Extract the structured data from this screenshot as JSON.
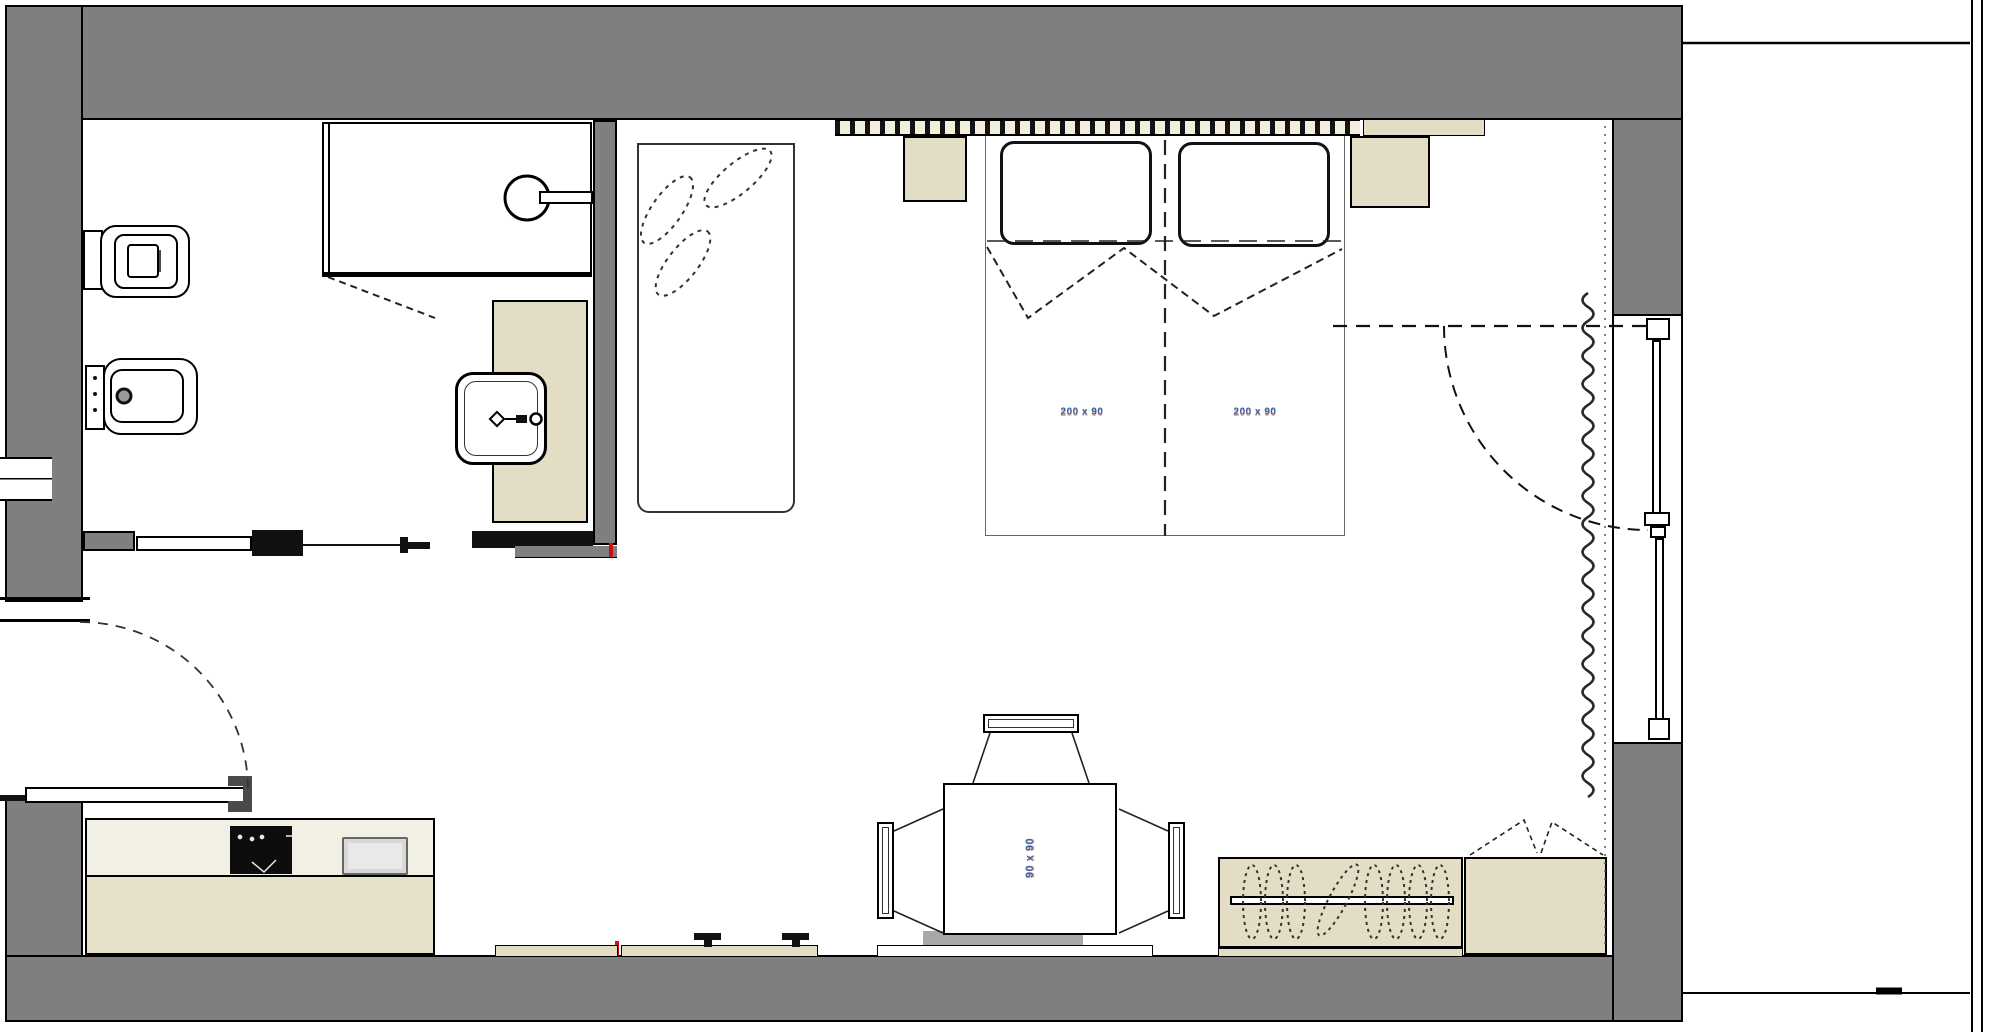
{
  "drawing": {
    "type": "apartment-floor-plan",
    "rooms": [
      "bathroom",
      "wardrobe-closet",
      "living-sleeping-area",
      "kitchen-dining-area",
      "balcony-terrace"
    ],
    "fixtures": [
      "toilet",
      "bidet",
      "shower",
      "washbasin",
      "sliding-door",
      "wardrobe",
      "double-bed",
      "nightstand",
      "radiator-curtain",
      "balcony-door",
      "window",
      "kitchen-counter",
      "cooktop",
      "sink",
      "entry-door",
      "dining-table",
      "chair",
      "clothes-rail",
      "cabinet"
    ]
  },
  "labels": {
    "bed_left_dimension": "200 x 90",
    "bed_right_dimension": "200 x 90",
    "table_dimension": "90 x 90"
  },
  "colors": {
    "wall_gray": "#7f7f7f",
    "line_black": "#000000",
    "furniture_tan": "#e3ddc5",
    "counter_tan": "#e7e1c9",
    "counter_surface": "#f2efe5",
    "headboard_cream": "#f3eed9",
    "cooktop_black": "#0d0d0d",
    "sink_gray": "#d8d8d6",
    "bench_gray": "#a8a8a8",
    "marker_red": "#cc1111",
    "dimension_blue": "#3a5fa8"
  }
}
